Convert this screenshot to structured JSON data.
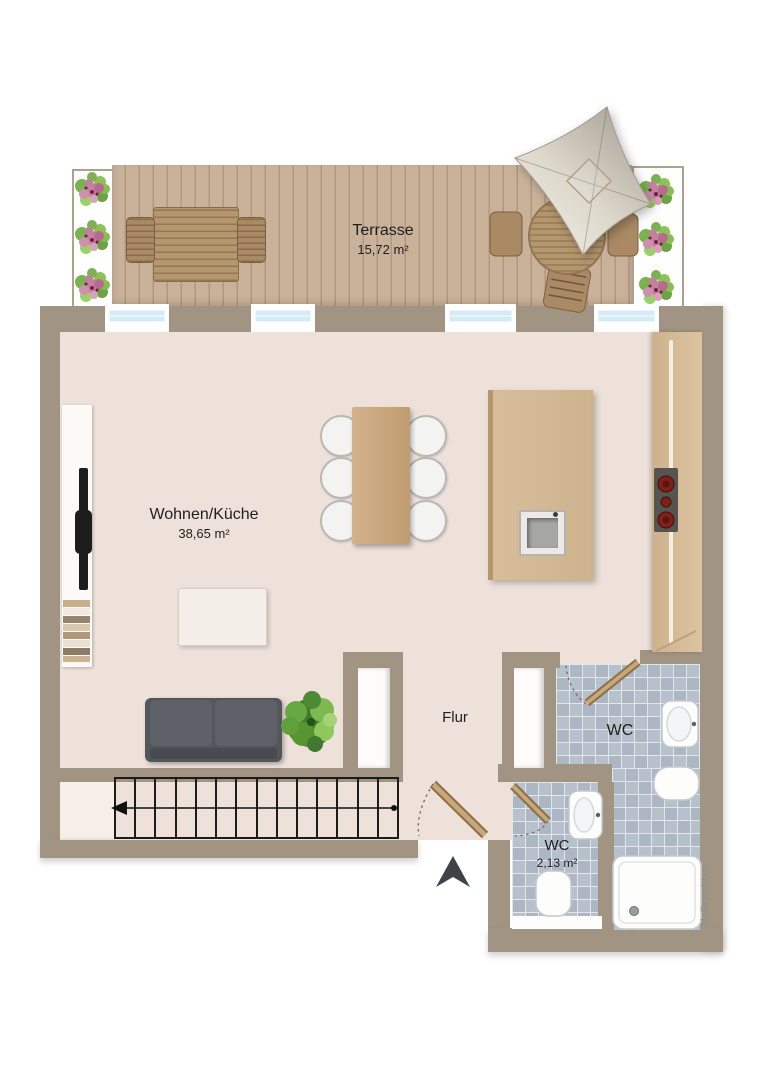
{
  "floorplan": {
    "watermark": "McGrundriss",
    "rooms": [
      {
        "key": "terrasse",
        "label": "Terrasse",
        "area": "15,72 m²"
      },
      {
        "key": "wohnen_kueche",
        "label": "Wohnen/Küche",
        "area": "38,65 m²"
      },
      {
        "key": "flur",
        "label": "Flur",
        "area": ""
      },
      {
        "key": "wc_oben",
        "label": "WC",
        "area": ""
      },
      {
        "key": "wc_unten",
        "label": "WC",
        "area": "2,13 m²"
      }
    ],
    "colors": {
      "wall": "#a29482",
      "floor": "#eee1da",
      "deck": "#c6ae94",
      "tile": "#b7c1cb",
      "window_glass": "#d3ebf4",
      "wood_furniture": "#d7bd9a",
      "sofa": "#53565b",
      "stair_line": "#1c1c1c"
    }
  }
}
